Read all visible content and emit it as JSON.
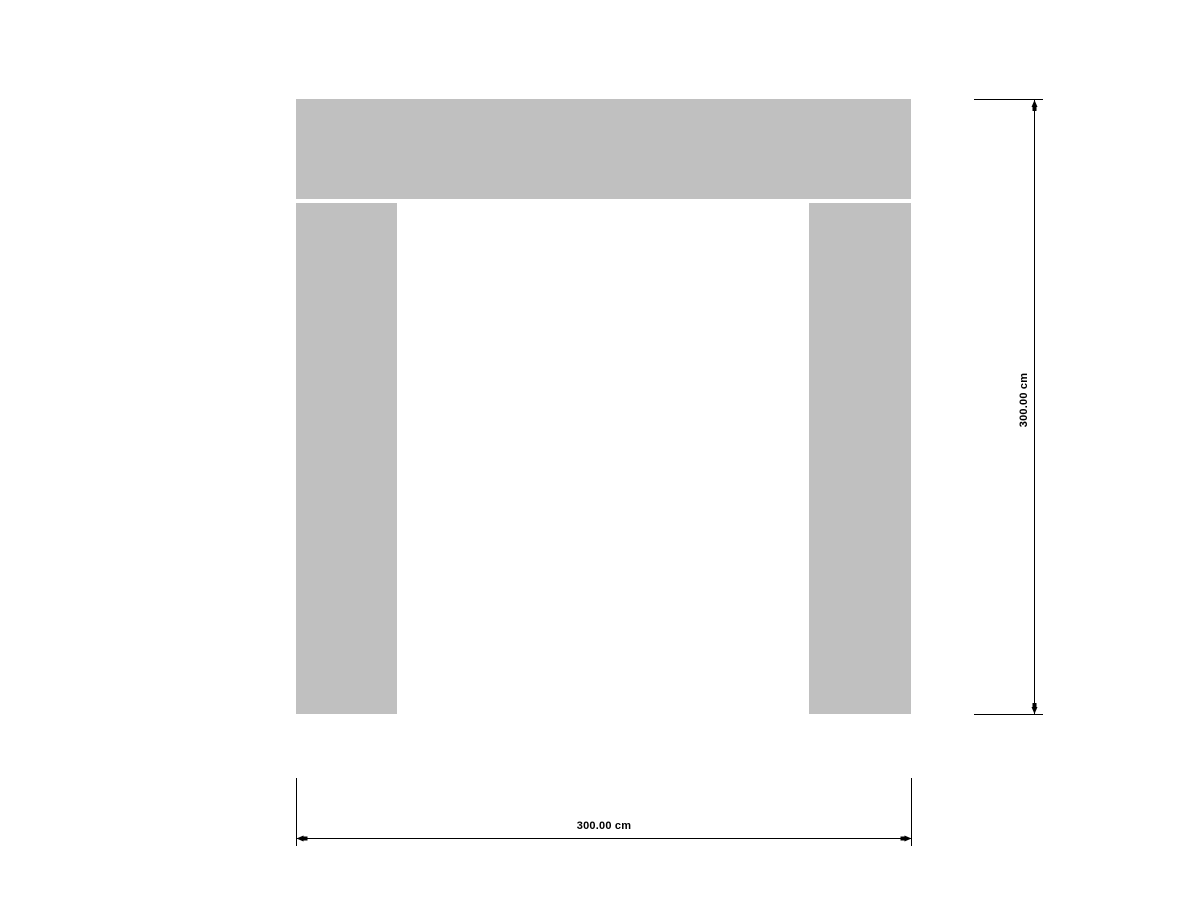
{
  "drawing": {
    "members": {
      "beam": "top-beam",
      "left_column": "left-column",
      "right_column": "right-column"
    },
    "dimensions": {
      "height": {
        "label": "300.00 cm"
      },
      "width": {
        "label": "300.00 cm"
      }
    }
  },
  "colors": {
    "background": "#ffffff",
    "member_fill": "#c0c0c0",
    "line": "#000000",
    "text": "#000000"
  }
}
